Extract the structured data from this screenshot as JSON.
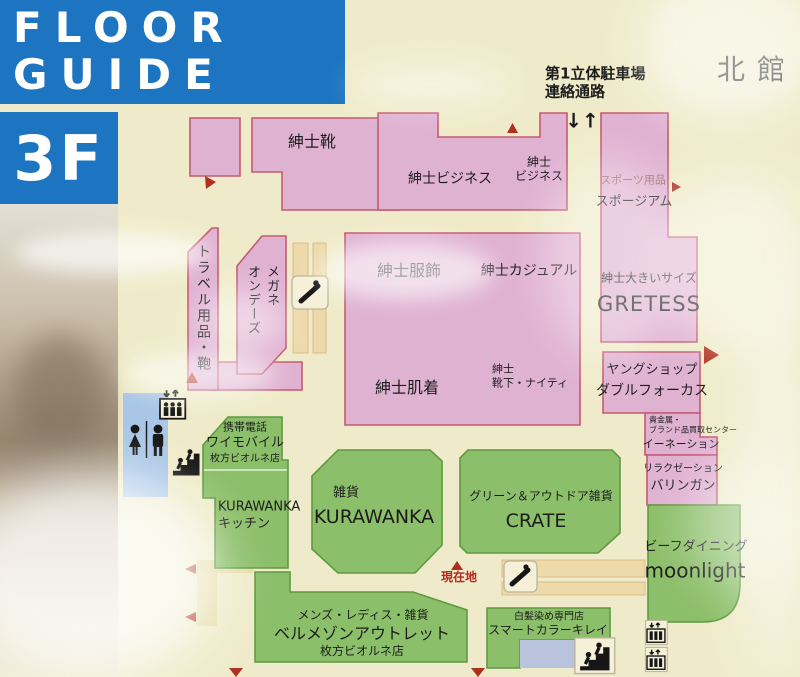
{
  "header": {
    "line1": "FLOOR",
    "line2": "GUIDE",
    "floor": "3F"
  },
  "top": {
    "building": "北館",
    "parking_line1": "第1立体駐車場",
    "parking_line2": "連絡通路",
    "arrows": "↓↑"
  },
  "marker": {
    "current_location": "現在地"
  },
  "areas": {
    "mens_shoes": "紳士靴",
    "mens_business": "紳士ビジネス",
    "mens_business2_l1": "紳士",
    "mens_business2_l2": "ビジネス",
    "sports_l1": "スポーツ用品",
    "sports_l2": "スポージアム",
    "mens_fashion": "紳士服飾",
    "mens_casual": "紳士カジュアル",
    "mens_underwear": "紳士肌着",
    "mens_socks_l1": "紳士",
    "mens_socks_l2": "靴下・ナイティ",
    "travel": "トラベル用品・鞄",
    "megane_l1": "メガネ",
    "megane_l2": "オンデーズ",
    "bigsize_l1": "紳士大きいサイズ",
    "bigsize_l2": "GRETESS",
    "young_l1": "ヤングショップ",
    "young_l2": "ダブルフォーカス",
    "buyback_l1": "貴金属・",
    "buyback_l2": "ブランド品買取センター",
    "buyback_l3": "イーネーション",
    "relax_l1": "リラクゼーション",
    "relax_l2": "バリンガン",
    "dining_l1": "ビーフダイニング",
    "dining_l2": "moonlight",
    "mobile_l1": "携帯電話",
    "mobile_l2": "ワイモバイル",
    "mobile_l3": "枚方ビオルネ店",
    "kitchen_l1": "KURAWANKA",
    "kitchen_l2": "キッチン",
    "zakka_l1": "雑貨",
    "zakka_l2": "KURAWANKA",
    "crate_l1": "グリーン＆アウトドア雑貨",
    "crate_l2": "CRATE",
    "outlet_l1": "メンズ・レディス・雑貨",
    "outlet_l2": "ベルメゾンアウトレット",
    "outlet_l3": "枚方ビオルネ店",
    "haircolor_l1": "白髪染め専門店",
    "haircolor_l2": "スマートカラーキレイ"
  },
  "icons": {
    "restroom": "restroom-pictogram",
    "elevator": "elevator-pictogram",
    "stairs": "stairs-pictogram",
    "escalator": "escalator-pictogram",
    "location_triangle": "red-triangle-marker"
  },
  "colors": {
    "header_blue": "#1d74c0",
    "area_pink": "#e0b2d2",
    "area_pink_border": "#c25b70",
    "area_green": "#8cbf6a",
    "area_green_border": "#5f9a42",
    "background_cream": "#efebca",
    "corridor_tan": "#eed9ab",
    "restroom_blue": "#a9c6e6",
    "marker_red": "#b03020"
  }
}
